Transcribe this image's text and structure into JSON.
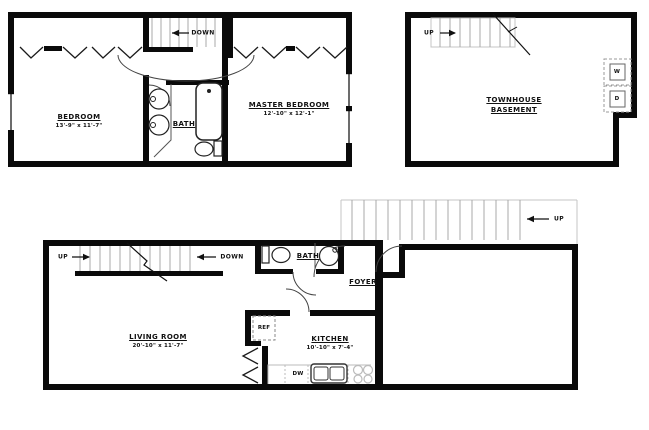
{
  "upper_floor": {
    "bedroom": {
      "name": "BEDROOM",
      "dims": "13'-9\" x 11'-7\""
    },
    "bath": {
      "name": "BATH"
    },
    "master_bedroom": {
      "name": "MASTER BEDROOM",
      "dims": "12'-10\" x 12'-1\""
    },
    "stair_label": "DOWN"
  },
  "basement": {
    "title_line1": "TOWNHOUSE",
    "title_line2": "BASEMENT",
    "stair_label": "UP",
    "washer": "W",
    "dryer": "D"
  },
  "main_floor": {
    "living_room": {
      "name": "LIVING ROOM",
      "dims": "20'-10\" x 11'-7\""
    },
    "kitchen": {
      "name": "KITCHEN",
      "dims": "10'-10\" x 7'-4\""
    },
    "bath": {
      "name": "BATH"
    },
    "foyer": {
      "name": "FOYER"
    },
    "refrigerator": "REF",
    "dishwasher": "DW",
    "stair_up_label": "UP",
    "stair_down_label": "DOWN",
    "exterior_stair_label": "UP"
  },
  "colors": {
    "wall": "#0a0a0a",
    "stair_line": "#a8a8a8",
    "fixture_line": "#333333",
    "dashed_line": "#999999",
    "background": "#ffffff"
  }
}
